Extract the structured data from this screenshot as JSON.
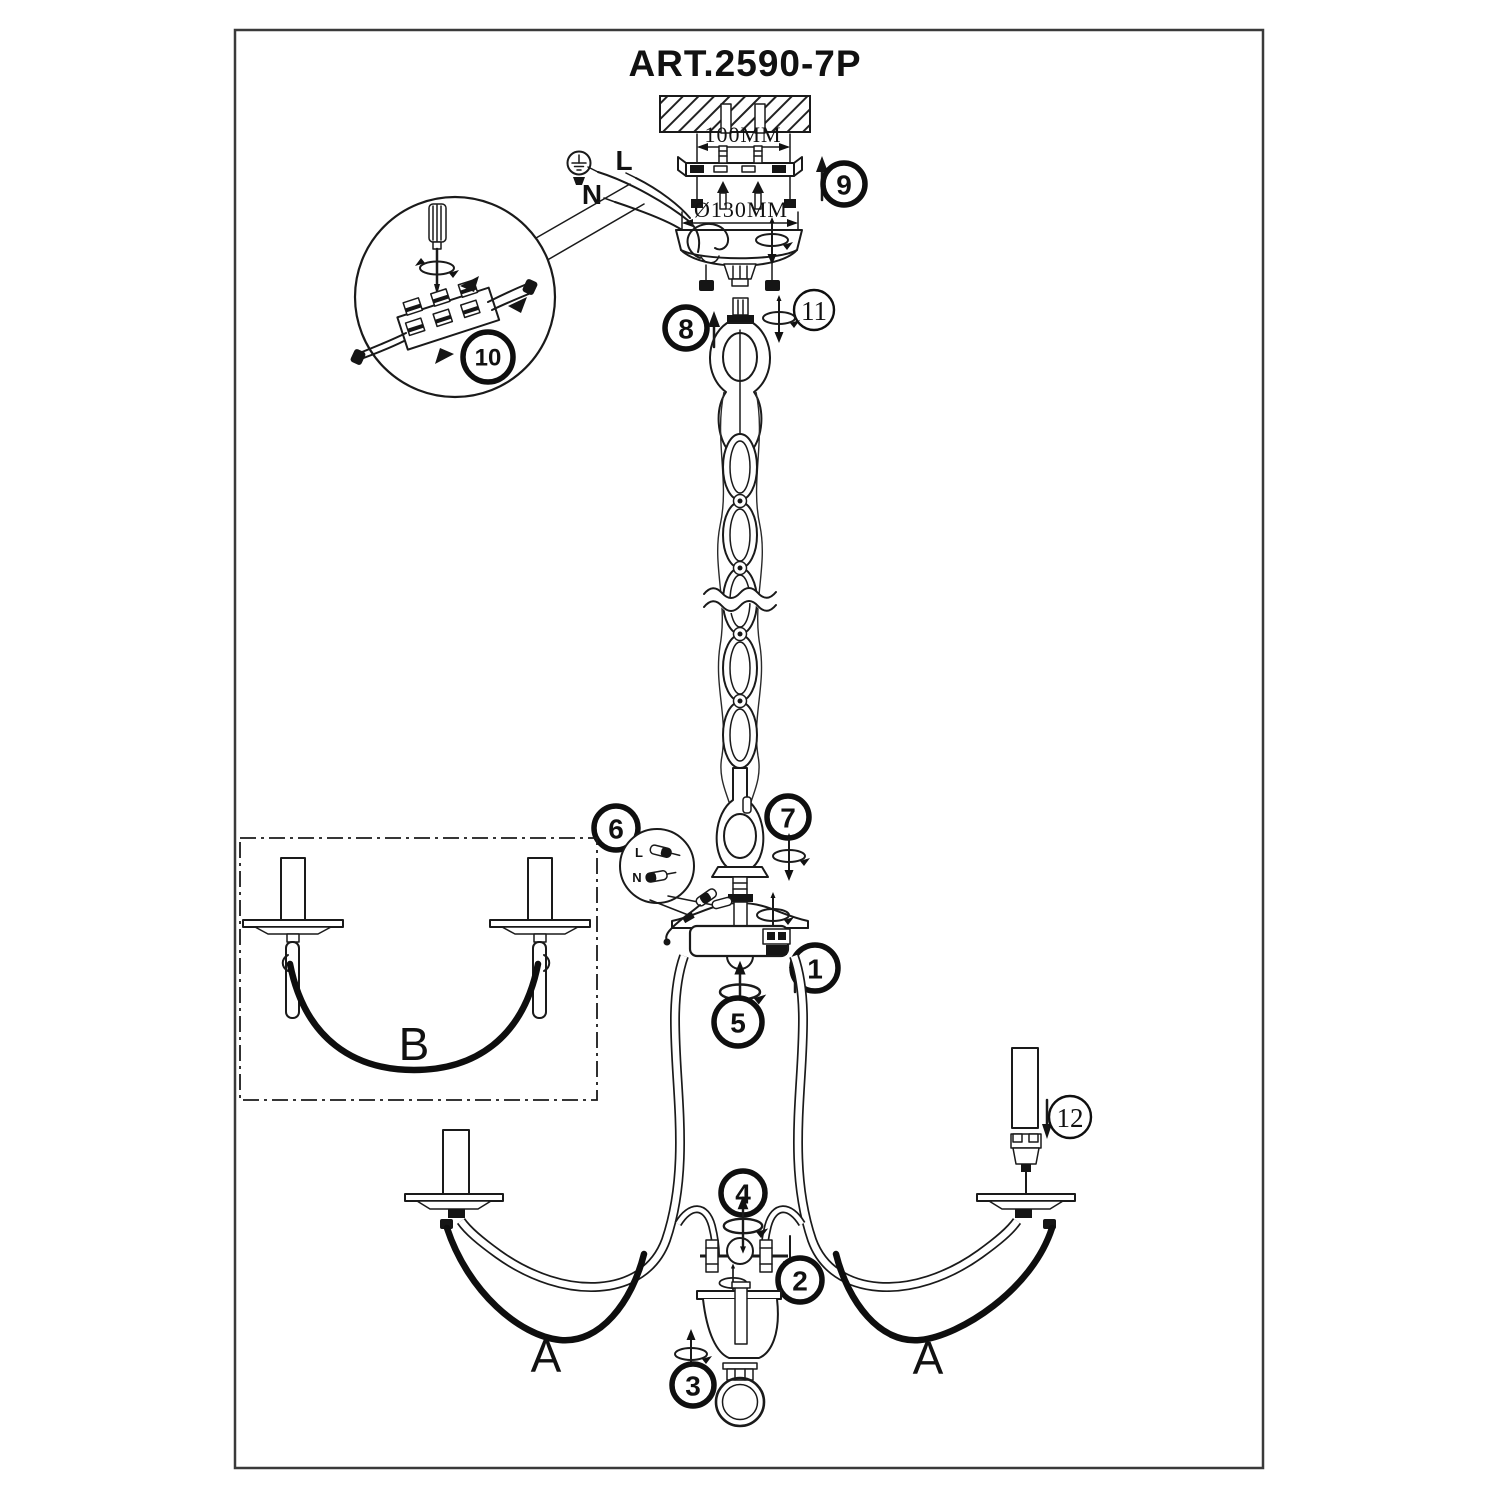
{
  "title": "ART.2590-7P",
  "dimensions": {
    "mount_width": "100MM",
    "canopy_diameter": "Ø130MM"
  },
  "wiring": {
    "live": "L",
    "neutral": "N",
    "connector_live": "L",
    "connector_neutral": "N"
  },
  "labels": {
    "swag_left": "A",
    "swag_right": "A",
    "inset_swag": "B"
  },
  "callouts": {
    "c1": "1",
    "c2": "2",
    "c3": "3",
    "c4": "4",
    "c5": "5",
    "c6": "6",
    "c7": "7",
    "c8": "8",
    "c9": "9",
    "c10": "10",
    "c11": "11",
    "c12": "12"
  }
}
